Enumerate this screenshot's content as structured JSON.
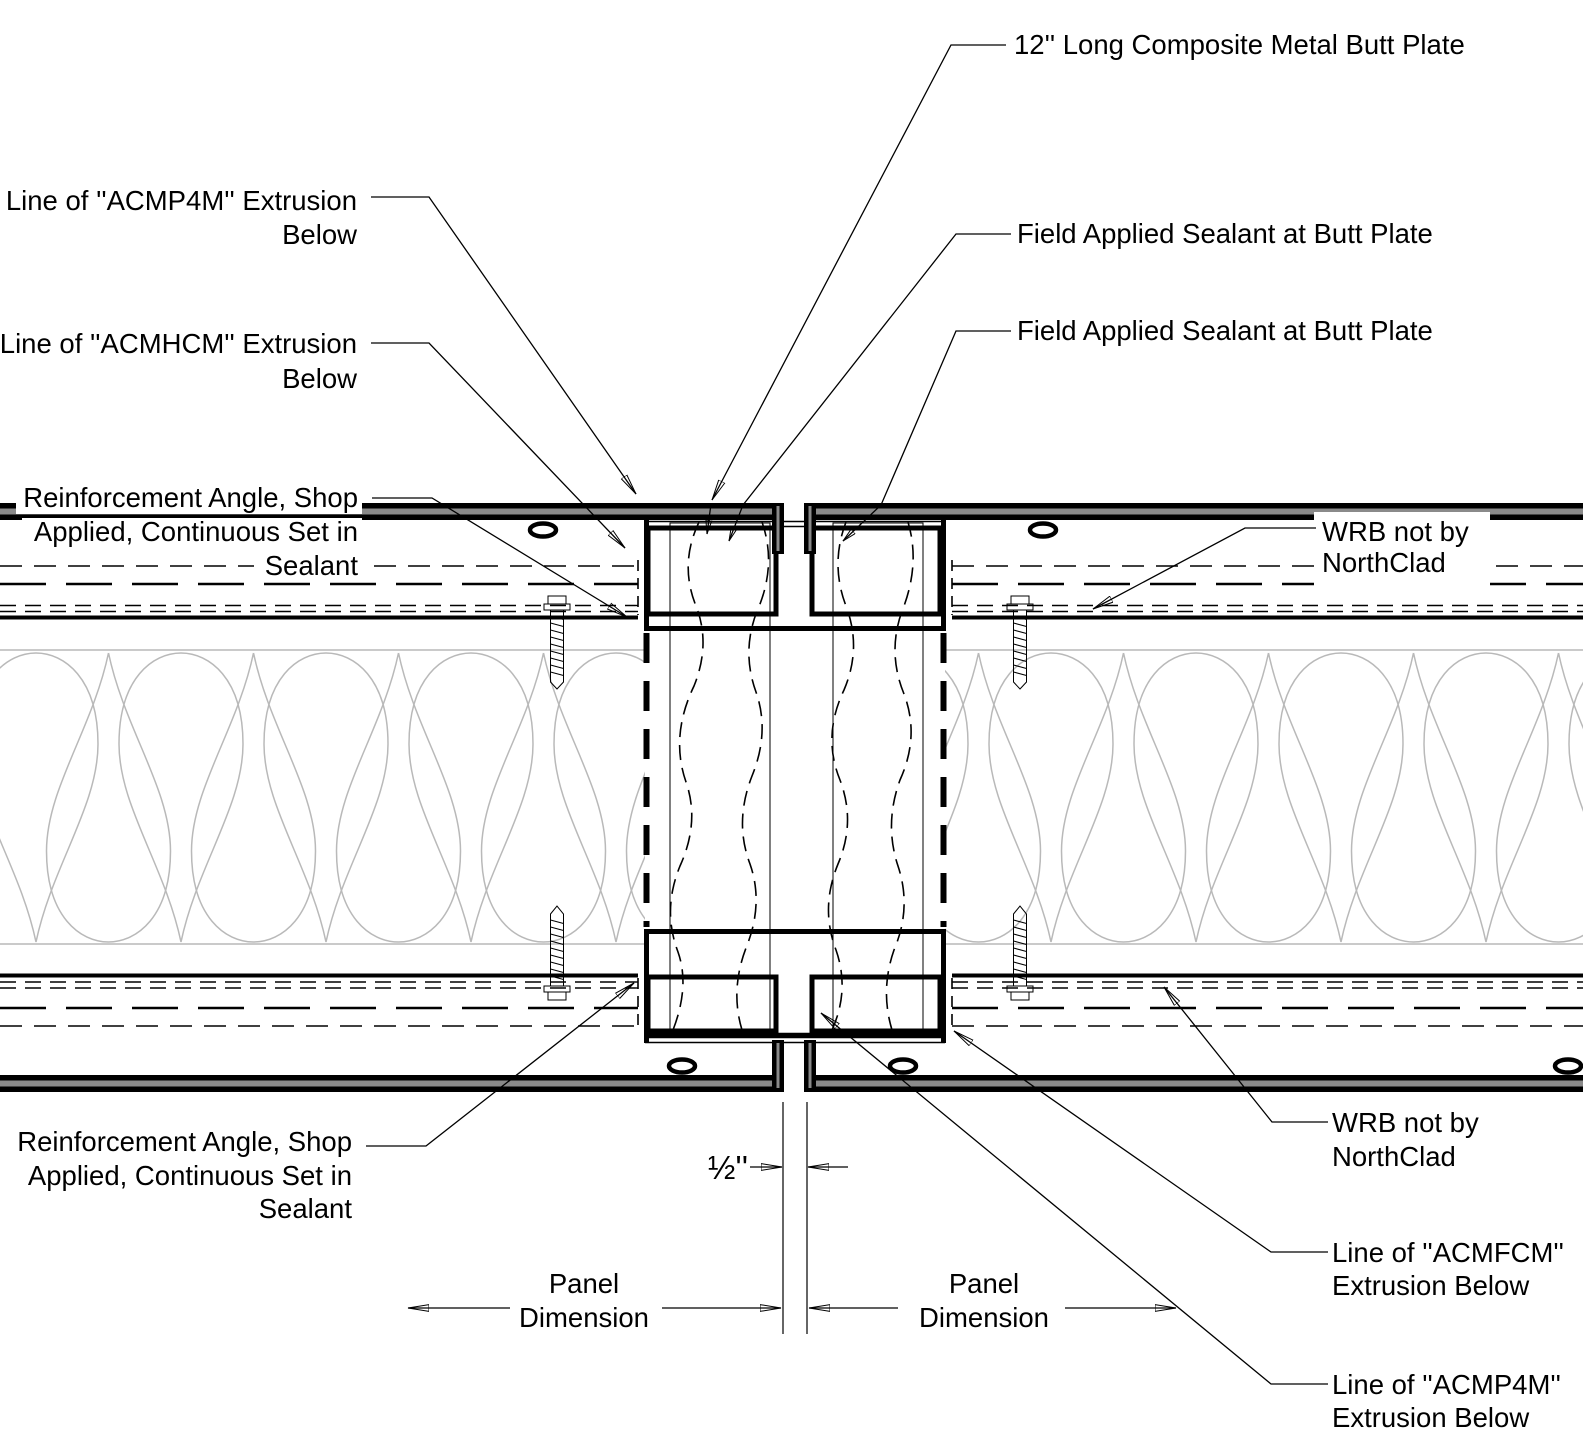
{
  "drawing": {
    "title_semantic": "ACM panel butt joint plan detail",
    "colors": {
      "line": "#000000",
      "core_gray": "#8a8a8a",
      "insulation_gray": "#b9b9b9",
      "screw_gray": "#9c9c9c",
      "dot_gray": "#cfcfcf",
      "background": "#ffffff"
    }
  },
  "labels": {
    "butt_plate": "12'' Long Composite Metal Butt Plate",
    "field_sealant_1": "Field Applied Sealant at Butt Plate",
    "field_sealant_2": "Field Applied Sealant at Butt Plate",
    "acmp4m_top": {
      "line1": "Line of ''ACMP4M'' Extrusion",
      "line2": "Below"
    },
    "acmhcm": {
      "line1": "Line of ''ACMHCM'' Extrusion",
      "line2": "Below"
    },
    "reinforcement_top": {
      "line1": "Reinforcement Angle, Shop",
      "line2": "Applied, Continuous Set in",
      "line3": "Sealant"
    },
    "wrb_top": {
      "line1": "WRB not by",
      "line2": "NorthClad"
    },
    "reinforcement_bottom": {
      "line1": "Reinforcement Angle, Shop",
      "line2": "Applied, Continuous Set in",
      "line3": "Sealant"
    },
    "wrb_bottom": {
      "line1": "WRB not by",
      "line2": "NorthClad"
    },
    "acmfcm_bottom": {
      "line1": "Line of ''ACMFCM''",
      "line2": "Extrusion Below"
    },
    "acmp4m_bottom": {
      "line1": "Line of ''ACMP4M''",
      "line2": "Extrusion Below"
    }
  },
  "dimensions": {
    "joint_gap": "½''",
    "panel_left": {
      "line1": "Panel",
      "line2": "Dimension"
    },
    "panel_right": {
      "line1": "Panel",
      "line2": "Dimension"
    }
  }
}
